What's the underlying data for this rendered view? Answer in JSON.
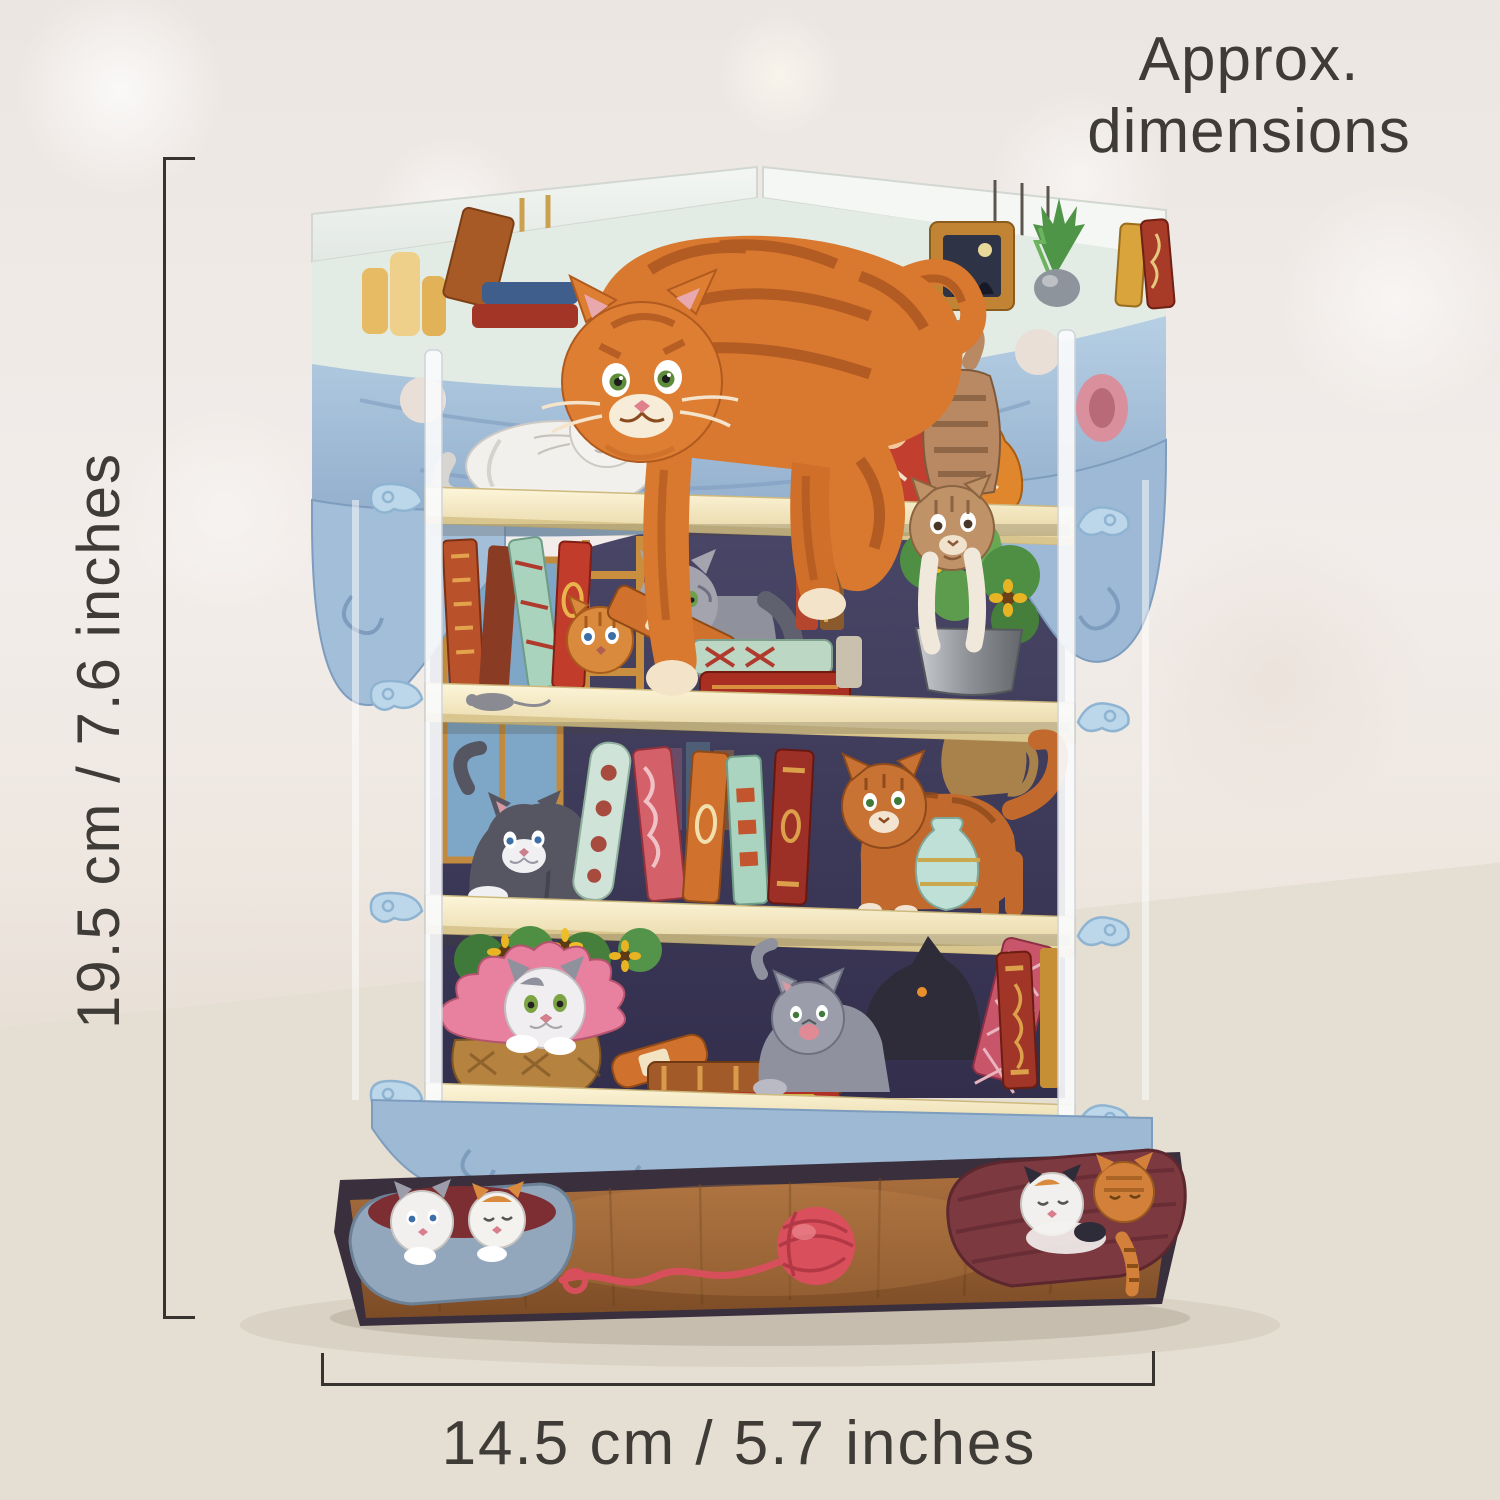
{
  "annotations": {
    "heading_line1": "Approx.",
    "heading_line2": "dimensions",
    "height_dimension": "19.5 cm / 7.6 inches",
    "width_dimension": "14.5 cm / 5.7 inches"
  },
  "colors": {
    "annotation_text": "#3f3b37",
    "dimension_line": "#37332e",
    "card_valance_blue": "#a3bed9",
    "shelf_cream": "#f6edc8",
    "interior_navy": "#413e5b",
    "tabby_orange": "#d9782f",
    "yarn_red": "#da4f5c",
    "wood_floor": "#9a6136",
    "table_wood": "#e5ded2"
  },
  "scene": {
    "subject": "3D pop-up greeting card of a bookshelf full of cats standing on a whitewashed wooden table",
    "elements": [
      "orange tabby cat lying on top shelf",
      "white cat lying on shelf one",
      "matryoshka dolls",
      "brown tabby kitten climbing into flower pot",
      "orange kitten peeking between books",
      "grey cat among books",
      "sunflower pot",
      "tuxedo kitten pouncing",
      "ginger cat with teal vase",
      "kitten in pink basket",
      "grey kitten with books",
      "black cat silhouette",
      "two kittens in grey basket",
      "sleeping kittens in red basket",
      "red ball of yarn"
    ]
  }
}
